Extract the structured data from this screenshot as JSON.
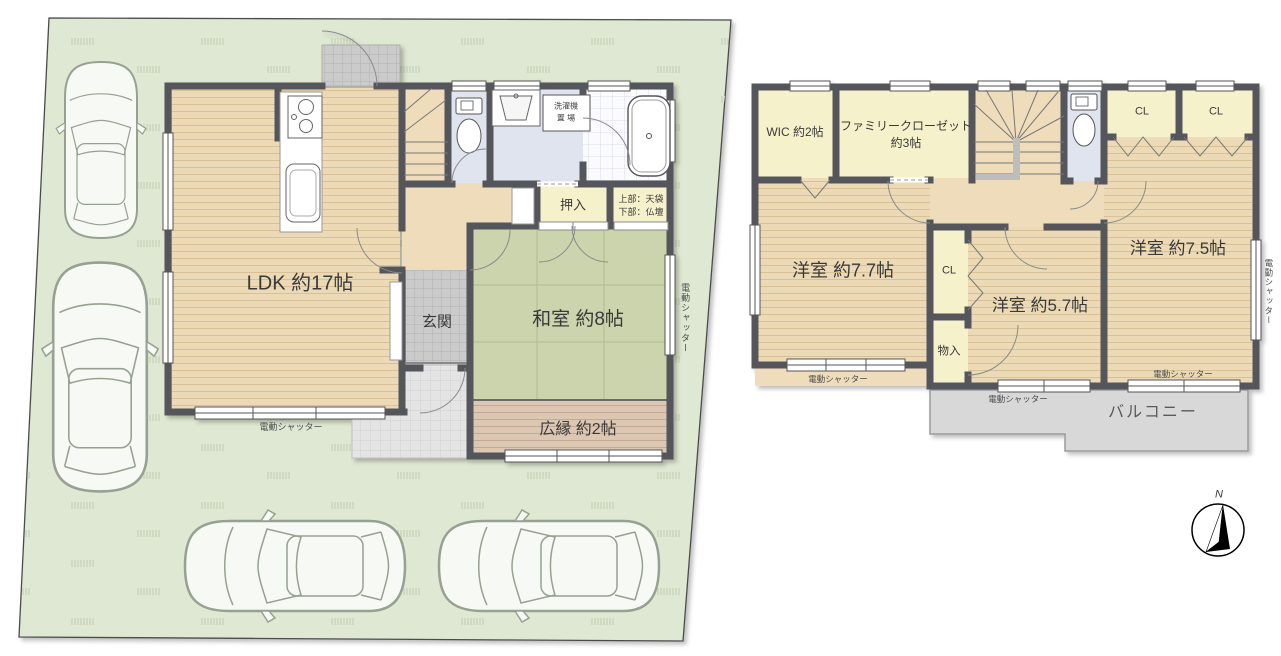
{
  "shutter_label": "電動シャッター",
  "floor1": {
    "ldk": "LDK 約17帖",
    "genkan": "玄関",
    "washitsu": "和室 約8帖",
    "hiroen": "広縁 約2帖",
    "oshiire": "押入",
    "tenbukuro": "上部：天袋",
    "butsudan": "下部：仏壇",
    "laundry_line1": "洗濯機",
    "laundry_line2": "置 場"
  },
  "floor2": {
    "wic": "WIC 約2帖",
    "family_closet": "ファミリークローゼット",
    "family_closet_size": "約3帖",
    "cl": "CL",
    "monoire": "物入",
    "room77": "洋室 約7.7帖",
    "room57": "洋室 約5.7帖",
    "room75": "洋室 約7.5帖",
    "balcony": "バルコニー"
  },
  "compass": {
    "north": "N"
  },
  "colors": {
    "wall": "#54555c",
    "wood_floor": "#ecdab6",
    "tatami": "#cbd4ac",
    "closet": "#f5f1ca",
    "water_floor": "#e0e4ef",
    "lot_green": "#dfe8d2",
    "balcony_gray": "#d8d8d8",
    "engawa": "#dcc7b3"
  }
}
